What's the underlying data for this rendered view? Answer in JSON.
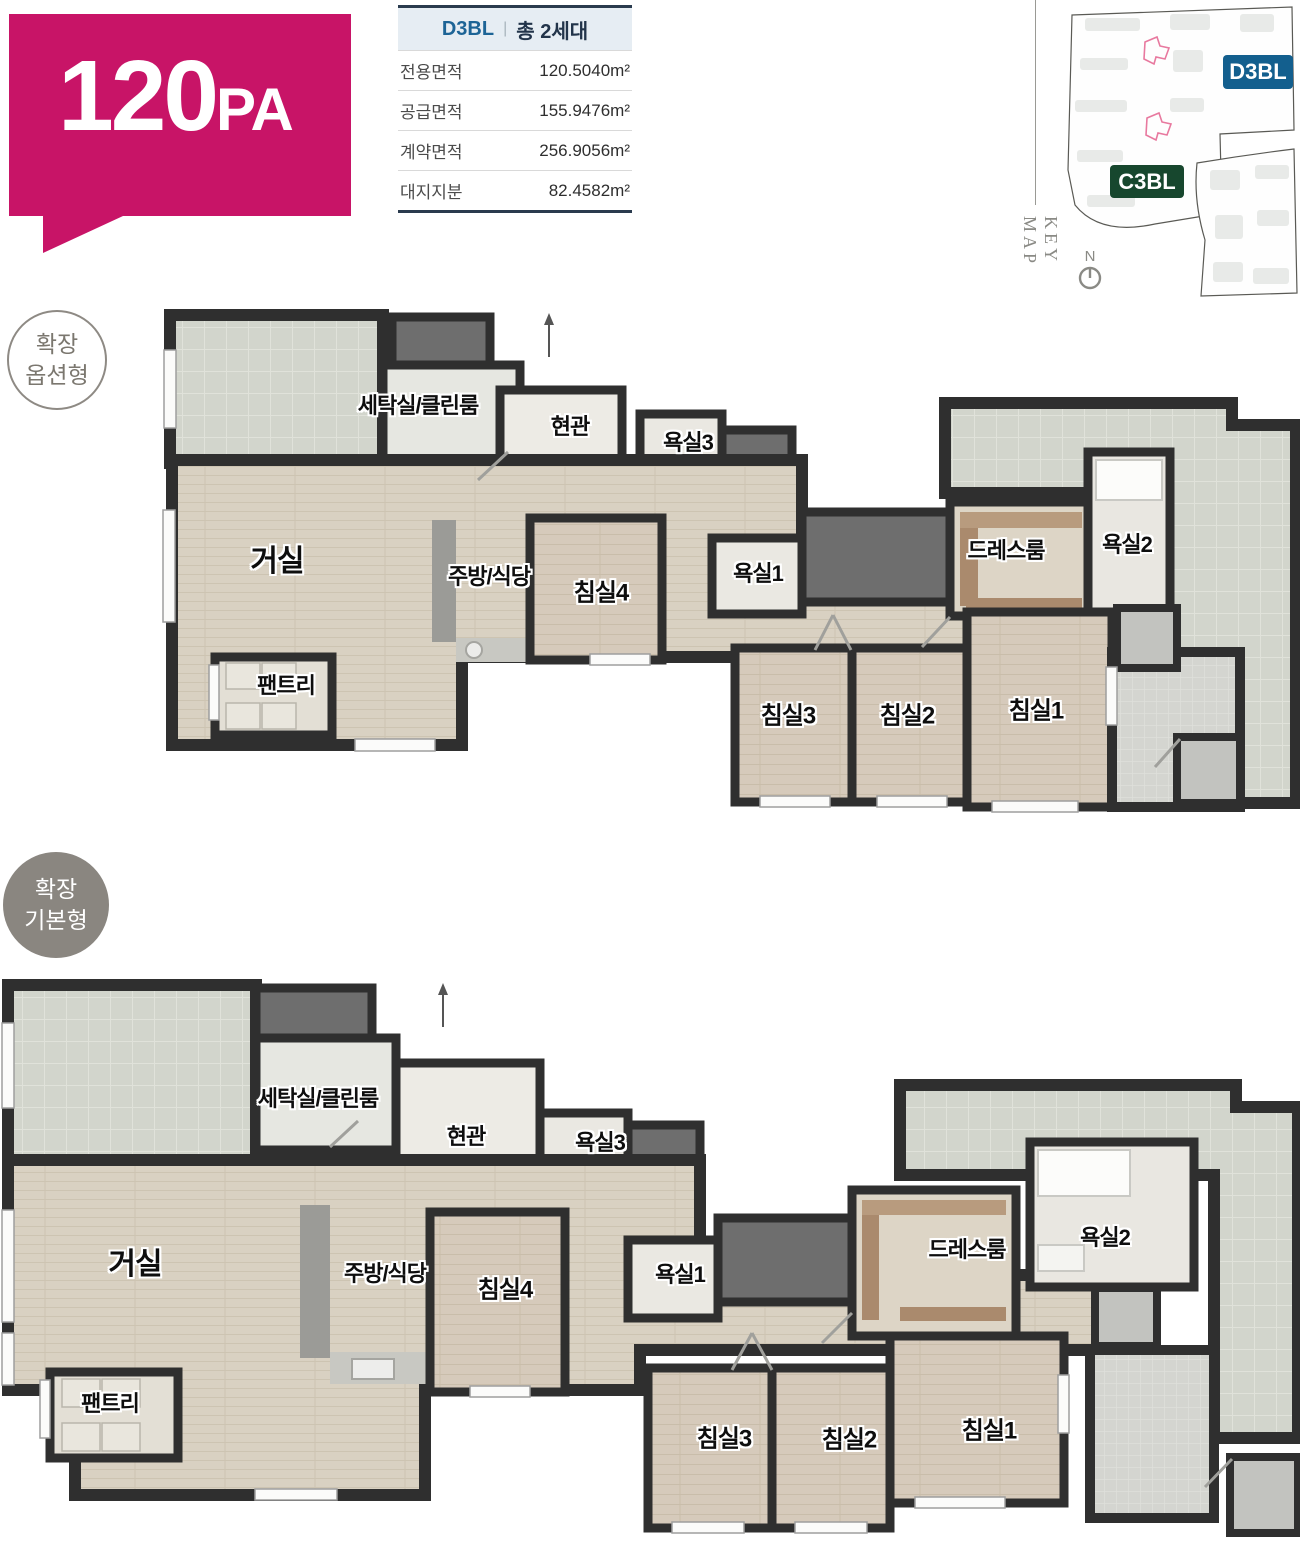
{
  "unit_badge": {
    "number": "120",
    "suffix": "PA"
  },
  "spec_table": {
    "block": "D3BL",
    "divider": "|",
    "total_units": "총 2세대",
    "rows": [
      {
        "label": "전용면적",
        "value": "120.5040m²"
      },
      {
        "label": "공급면적",
        "value": "155.9476m²"
      },
      {
        "label": "계약면적",
        "value": "256.9056m²"
      },
      {
        "label": "대지지분",
        "value": "82.4582m²"
      }
    ]
  },
  "key_map": {
    "title": "KEY MAP",
    "north_label": "N",
    "block_labels": [
      {
        "text": "D3BL"
      },
      {
        "text": "C3BL"
      }
    ]
  },
  "plans": [
    {
      "badge_lines": [
        "확장",
        "옵션형"
      ],
      "rooms": [
        {
          "label": "세탁실/클린룸",
          "x": 258,
          "y": 99
        },
        {
          "label": "현관",
          "x": 410,
          "y": 120
        },
        {
          "label": "욕실3",
          "x": 528,
          "y": 136
        },
        {
          "label": "거실",
          "x": 117,
          "y": 253,
          "size": 30
        },
        {
          "label": "주방/식당",
          "x": 329,
          "y": 270
        },
        {
          "label": "침실4",
          "x": 441,
          "y": 285,
          "size": 24
        },
        {
          "label": "욕실1",
          "x": 598,
          "y": 267
        },
        {
          "label": "드레스룸",
          "x": 846,
          "y": 244
        },
        {
          "label": "욕실2",
          "x": 967,
          "y": 238
        },
        {
          "label": "팬트리",
          "x": 126,
          "y": 379
        },
        {
          "label": "침실3",
          "x": 628,
          "y": 408,
          "size": 24
        },
        {
          "label": "침실2",
          "x": 747,
          "y": 408,
          "size": 24
        },
        {
          "label": "침실1",
          "x": 876,
          "y": 403,
          "size": 24
        }
      ]
    },
    {
      "badge_lines": [
        "확장",
        "기본형"
      ],
      "rooms": [
        {
          "label": "세탁실/클린룸",
          "x": 318,
          "y": 122
        },
        {
          "label": "현관",
          "x": 466,
          "y": 160
        },
        {
          "label": "욕실3",
          "x": 600,
          "y": 166
        },
        {
          "label": "거실",
          "x": 135,
          "y": 286,
          "size": 30
        },
        {
          "label": "주방/식당",
          "x": 385,
          "y": 297
        },
        {
          "label": "침실4",
          "x": 505,
          "y": 312,
          "size": 24
        },
        {
          "label": "욕실1",
          "x": 680,
          "y": 298
        },
        {
          "label": "드레스룸",
          "x": 967,
          "y": 273
        },
        {
          "label": "욕실2",
          "x": 1105,
          "y": 261
        },
        {
          "label": "팬트리",
          "x": 110,
          "y": 427
        },
        {
          "label": "침실3",
          "x": 724,
          "y": 461,
          "size": 24
        },
        {
          "label": "침실2",
          "x": 849,
          "y": 462,
          "size": 24
        },
        {
          "label": "침실1",
          "x": 989,
          "y": 453,
          "size": 24
        }
      ]
    }
  ],
  "colors": {
    "accent": "#c81467",
    "d3bl": "#135f8e",
    "c3bl": "#17472e",
    "navy": "#2a3b4e",
    "blue": "#1d6496"
  }
}
